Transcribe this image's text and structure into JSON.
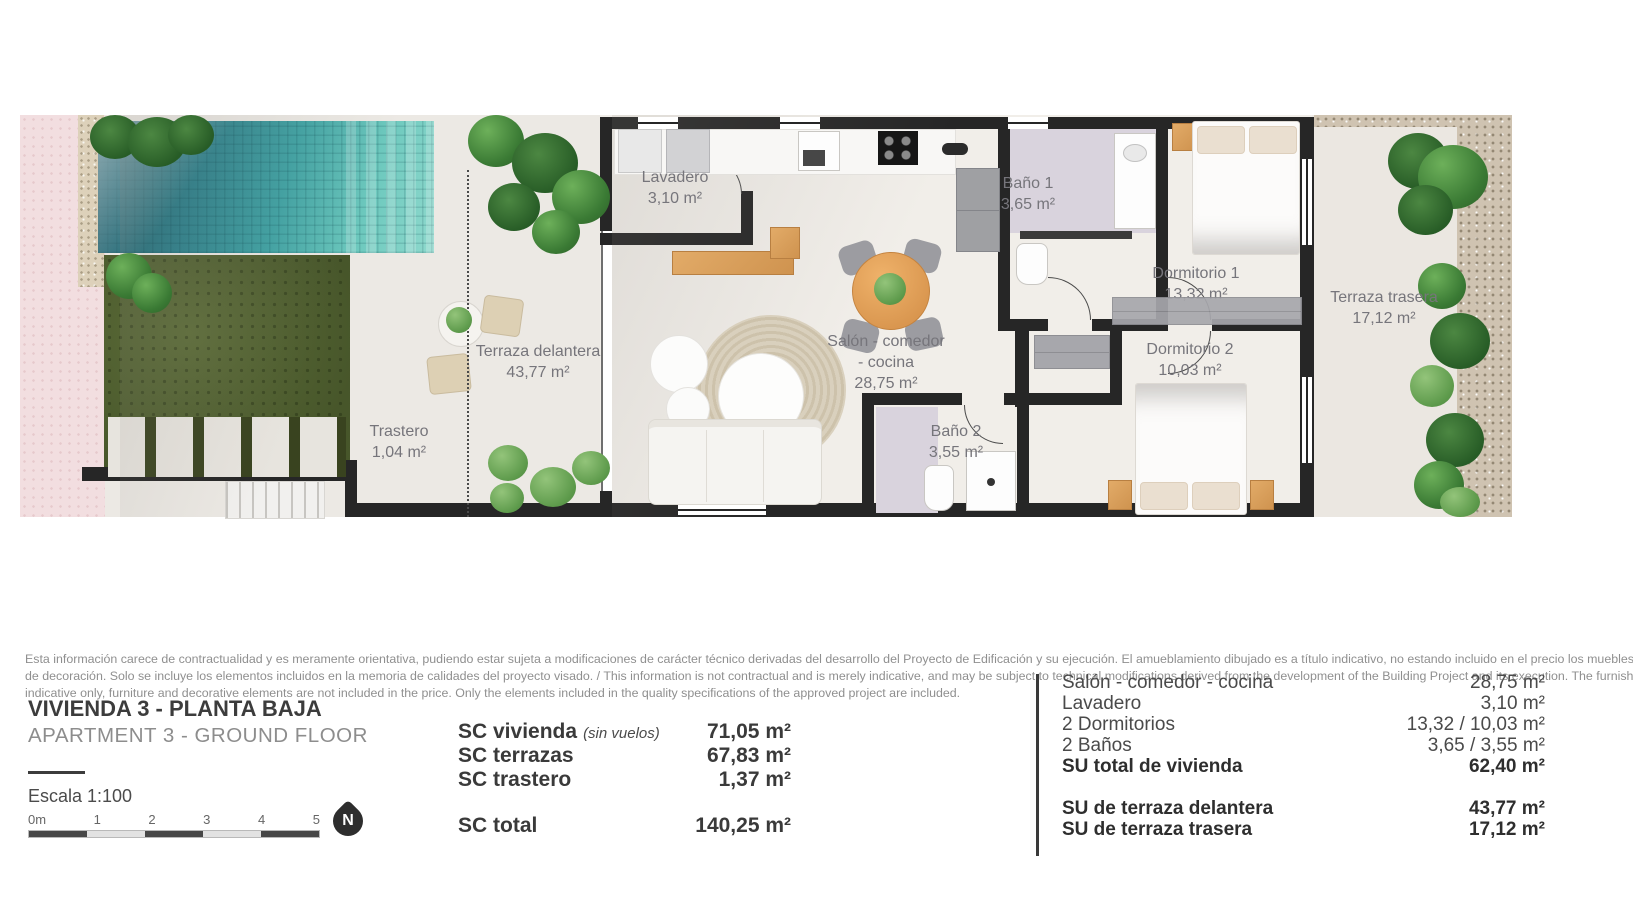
{
  "plan": {
    "rooms": {
      "lavadero": {
        "name": "Lavadero",
        "area": "3,10 m²"
      },
      "bano1": {
        "name": "Baño 1",
        "area": "3,65 m²"
      },
      "dormitorio1": {
        "name": "Dormitorio 1",
        "area": "13,32 m²"
      },
      "terraza_trasera": {
        "name": "Terraza trasera",
        "area": "17,12 m²"
      },
      "dormitorio2": {
        "name": "Dormitorio 2",
        "area": "10,03 m²"
      },
      "salon": {
        "name_line1": "Salón - comedor",
        "name_line2": "- cocina",
        "area": "28,75 m²"
      },
      "bano2": {
        "name": "Baño 2",
        "area": "3,55 m²"
      },
      "terraza_delantera": {
        "name": "Terraza delantera",
        "area": "43,77 m²"
      },
      "trastero": {
        "name": "Trastero",
        "area": "1,04 m²"
      }
    }
  },
  "disclaimer": {
    "lines": [
      "Esta información carece de contractualidad y es meramente orientativa, pudiendo estar sujeta a modificaciones de carácter técnico derivadas del desarrollo del Proyecto de Edificación y su ejecución. El amueblamiento dibujado es a título indicativo, no estando incluido en el precio los muebles y los elementos",
      "de decoración. Solo se incluye los elementos incluidos en la memoria de calidades del proyecto visado. / This information is not contractual and is merely indicative, and may be subject to technical modifications derived from the development of the Building Project and its execution. The furnishings shown are",
      "indicative only, furniture and decorative elements are not included in the price. Only the elements included in the quality specifications of the approved project are included."
    ]
  },
  "title_block": {
    "title_es": "VIVIENDA 3 - PLANTA BAJA",
    "title_en": "APARTMENT 3 - GROUND FLOOR",
    "scale_label": "Escala 1:100"
  },
  "scale_bar": {
    "ticks": [
      "0m",
      "1",
      "2",
      "3",
      "4",
      "5"
    ]
  },
  "compass": {
    "label": "N"
  },
  "sc_table": {
    "rows": [
      {
        "label": "SC vivienda",
        "note": "(sin vuelos)",
        "value": "71,05 m²"
      },
      {
        "label": "SC terrazas",
        "note": "",
        "value": "67,83 m²"
      },
      {
        "label": "SC trastero",
        "note": "",
        "value": "1,37 m²"
      }
    ],
    "total": {
      "label": "SC total",
      "value": "140,25 m²"
    }
  },
  "su_table": {
    "rows": [
      {
        "label": "Salón - comedor - cocina",
        "value": "28,75 m²"
      },
      {
        "label": "Lavadero",
        "value": "3,10 m²"
      },
      {
        "label": "2 Dormitorios",
        "value": "13,32 / 10,03 m²"
      },
      {
        "label": "2 Baños",
        "value": "3,65 / 3,55 m²"
      },
      {
        "label": "SU total de vivienda",
        "value": "62,40 m²"
      }
    ],
    "terrace_rows": [
      {
        "label": "SU de terraza delantera",
        "value": "43,77 m²"
      },
      {
        "label": "SU de terraza trasera",
        "value": "17,12 m²"
      }
    ]
  },
  "colors": {
    "wall": "#262626",
    "pool": "#2a7f8a",
    "grass": "#4d5c2d",
    "wood": "#d9a05f",
    "pink_ground": "#f2dee0",
    "gravel": "#cfc3b1"
  }
}
